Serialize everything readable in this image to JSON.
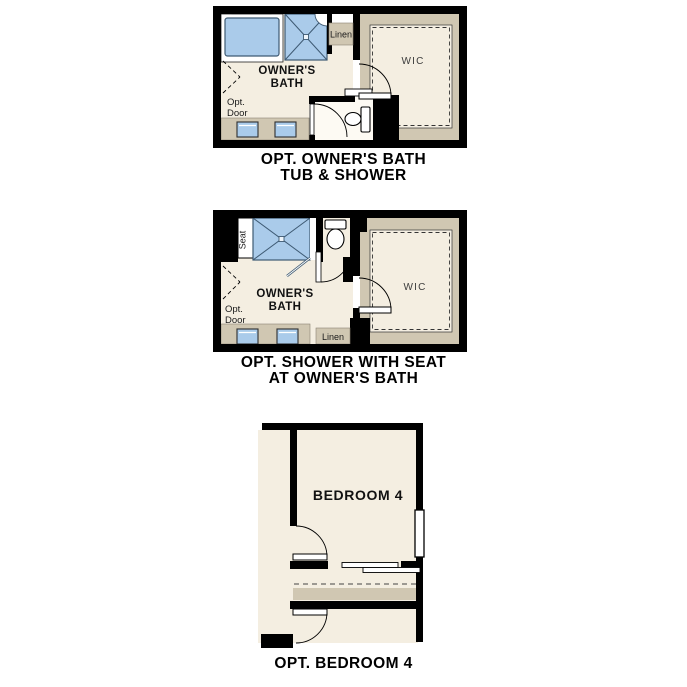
{
  "document": {
    "background": "#ffffff"
  },
  "colors": {
    "wall": "#000000",
    "floor": "#f4eee1",
    "counter_tan": "#d0c7b2",
    "fixture_blue": "#aacbea",
    "fixture_stroke": "#3e5a73",
    "label_text": "#111111",
    "wic_text": "#3c3c3c"
  },
  "plans": [
    {
      "caption_line1": "OPT. OWNER'S BATH",
      "caption_line2": "TUB & SHOWER",
      "labels": {
        "room_line1": "OWNER'S",
        "room_line2": "BATH",
        "wic": "WIC",
        "linen": "Linen",
        "opt_line1": "Opt.",
        "opt_line2": "Door"
      }
    },
    {
      "caption_line1": "OPT. SHOWER WITH SEAT",
      "caption_line2": "AT OWNER'S BATH",
      "labels": {
        "room_line1": "OWNER'S",
        "room_line2": "BATH",
        "wic": "WIC",
        "linen": "Linen",
        "seat": "Seat",
        "opt_line1": "Opt.",
        "opt_line2": "Door"
      }
    },
    {
      "caption_line1": "OPT. BEDROOM 4",
      "labels": {
        "room": "BEDROOM 4"
      }
    }
  ]
}
